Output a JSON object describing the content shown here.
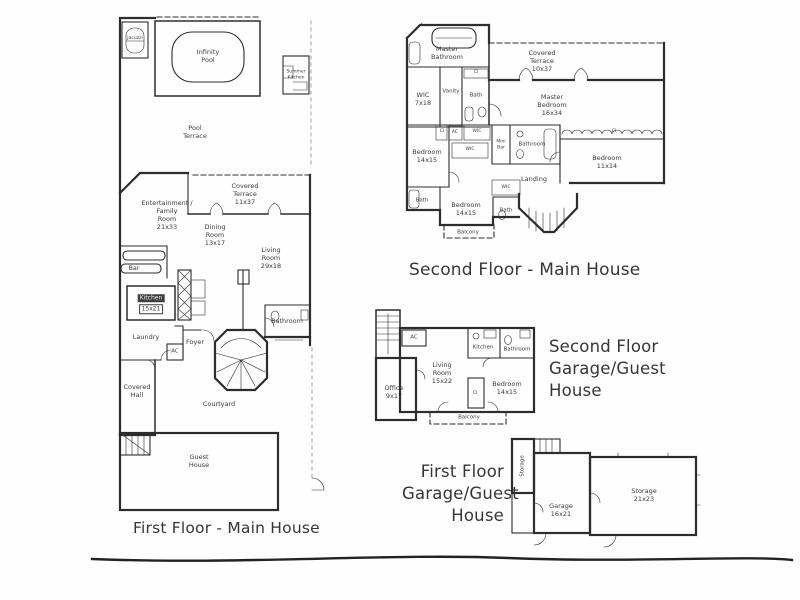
{
  "colors": {
    "paper": "#ffffff",
    "ink": "#2d2d30",
    "label": "#3b3b3e",
    "title": "#37343d",
    "faint": "#9a9a9a"
  },
  "plans": {
    "first_floor_main": {
      "title": "First Floor - Main House",
      "rooms": {
        "jacuzzi": "Jacuzzi",
        "infinity_pool": "Infinity\nPool",
        "summer_kitchen": "Summer\nKitchen",
        "pool_terrace": "Pool\nTerrace",
        "covered_terrace": "Covered\nTerrace\n11x37",
        "entertainment_family_room": "Entertainment /\nFamily\nRoom\n21x33",
        "dining_room": "Dining\nRoom\n13x17",
        "living_room": "Living\nRoom\n29x18",
        "bar": "Bar",
        "kitchen_name": "Kitchen",
        "kitchen_size": "15x21",
        "laundry": "Laundry",
        "ac": "AC",
        "foyer": "Foyer",
        "bathroom": "Bathroom",
        "covered_hall": "Covered\nHall",
        "courtyard": "Courtyard",
        "guest_house": "Guest\nHouse"
      }
    },
    "second_floor_main": {
      "title": "Second Floor - Main House",
      "rooms": {
        "master_bathroom": "Master\nBathroom",
        "covered_terrace": "Covered\nTerrace\n10x37",
        "vanity": "Vanity",
        "ci_top": "CI",
        "bath_top": "Bath",
        "wic_7x18": "WIC\n7x18",
        "master_bedroom": "Master\nBedroom\n16x34",
        "ci_left": "CI",
        "ac": "AC",
        "wic_upper": "WIC",
        "wic_lower": "WIC",
        "bedroom_left": "Bedroom\n14x15",
        "mini_bar": "Mini\nBar",
        "bathroom_center": "Bathroom",
        "ci_right": "CI",
        "bedroom_right": "Bedroom\n11x14",
        "landing": "Landing",
        "wic_landing": "WIC",
        "bath_left": "Bath",
        "bedroom_bottom": "Bedroom\n14x15",
        "bath_bottom": "Bath",
        "balcony": "Balcony"
      }
    },
    "second_floor_garage": {
      "title": "Second Floor\nGarage/Guest\nHouse",
      "rooms": {
        "ac": "AC",
        "kitchen": "Kitchen",
        "bathroom": "Bathroom",
        "living_room": "Living\nRoom\n15x22",
        "office": "Office\n9x17",
        "bedroom": "Bedroom\n14x15",
        "ci": "CI",
        "balcony": "Balcony"
      }
    },
    "first_floor_garage": {
      "title": "First Floor\nGarage/Guest\nHouse",
      "rooms": {
        "storage_left": "Storage",
        "garage": "Garage\n16x21",
        "storage_right": "Storage\n21x23"
      }
    }
  }
}
